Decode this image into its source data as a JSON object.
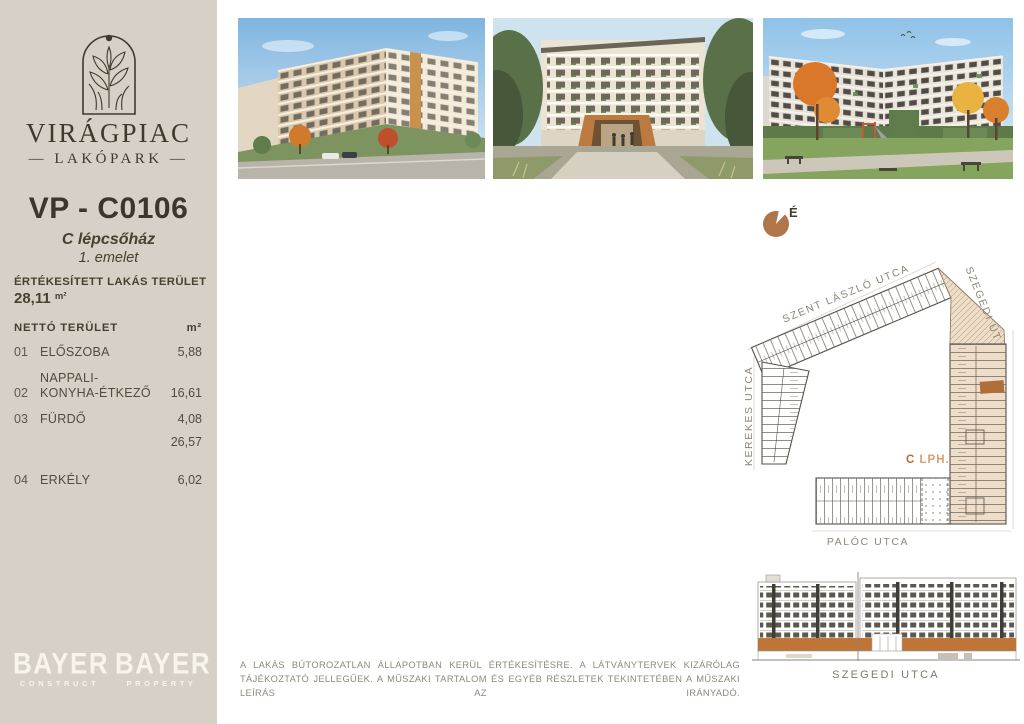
{
  "colors": {
    "sidebar_bg": "#d7d0c6",
    "ink": "#3f3a2b",
    "accent_brown": "#b1754a",
    "accent_orange": "#c0672e",
    "highlight_beige": "#eeddc8",
    "muted_gray": "#8d8779",
    "logo_white": "#f7f4ee"
  },
  "brand": {
    "title": "VIRÁGPIAC",
    "subtitle": "— LAKÓPARK —"
  },
  "unit": {
    "id": "VP - C0106",
    "staircase": "C lépcsőház",
    "floor": "1. emelet"
  },
  "sold_area": {
    "label": "ÉRTÉKESÍTETT LAKÁS TERÜLET",
    "value": "28,11",
    "unit": "m²"
  },
  "area_table": {
    "header": {
      "label": "NETTÓ TERÜLET",
      "unit": "m²"
    },
    "rows": [
      {
        "num": "01",
        "label": "ELŐSZOBA",
        "value": "5,88"
      },
      {
        "num": "02",
        "label_line1": "NAPPALI-",
        "label_line2": "KONYHA-ÉTKEZŐ",
        "value": "16,61"
      },
      {
        "num": "03",
        "label": "FÜRDŐ",
        "value": "4,08"
      }
    ],
    "subtotal": "26,57",
    "balcony_row": {
      "num": "04",
      "label": "ERKÉLY",
      "value": "6,02"
    }
  },
  "developer": {
    "logos": [
      {
        "name": "BAYER",
        "division": "CONSTRUCT"
      },
      {
        "name": "BAYER",
        "division": "PROPERTY"
      }
    ]
  },
  "site_plan": {
    "north_label": "É",
    "streets": {
      "top": "SZENT LÁSZLÓ UTCA",
      "right": "SZEGEDI ÚT",
      "left": "KEREKES UTCA",
      "bottom": "PALÓC UTCA"
    },
    "stair_label": {
      "letter": "C",
      "text": "LPH."
    }
  },
  "elevation": {
    "street": "SZEGEDI UTCA"
  },
  "disclaimer": {
    "text": "A LAKÁS BÚTOROZATLAN ÁLLAPOTBAN KERÜL ÉRTÉKESÍTÉSRE. A LÁTVÁNYTERVEK KIZÁRÓLAG TÁJÉKOZTATÓ JELLEGŰEK. A MŰSZAKI TARTALOM ÉS EGYÉB RÉSZLETEK TEKINTETÉBEN A MŰSZAKI LEÍRÁS AZ IRÁNYADÓ."
  }
}
